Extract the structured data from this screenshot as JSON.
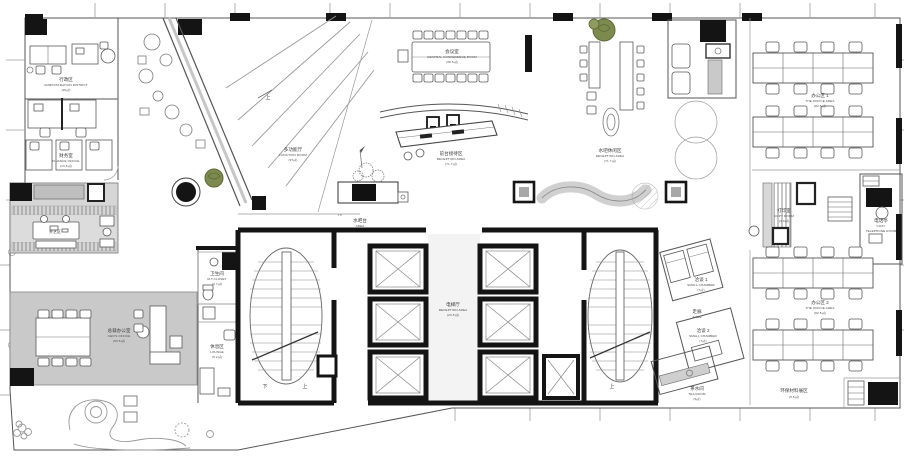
{
  "drawing": {
    "kind": "office floor plan",
    "colors": {
      "paper": "#ffffff",
      "wall_black": "#141414",
      "line_dark": "#555555",
      "line_light": "#9a9a9a",
      "room_gray": "#c9c9c9",
      "hatch_gray": "#bfbfbf",
      "plant_green": "#7d8a4f"
    }
  },
  "labels": {
    "admin": {
      "zh": "行政区",
      "en": "ADMINISTRATION DISTRICT",
      "area": "(26㎡)"
    },
    "finance": {
      "zh": "财务室",
      "en": "FINANCE OFFICE",
      "area": "(13.5㎡)"
    },
    "tea_art": {
      "zh": "茶艺区"
    },
    "ceo": {
      "zh": "总裁办公室",
      "en": "CEO'S OFFICE",
      "area": "(53.5㎡)"
    },
    "function": {
      "zh": "多功能厅",
      "en": "FUNCTION ROOM",
      "area": "(97㎡)"
    },
    "conference": {
      "zh": "会议室",
      "en": "CENTRAL CONFERENCE ROOM",
      "area": "(38.5㎡)"
    },
    "reception": {
      "zh": "前台接待区",
      "en": "RECEPTION AREA",
      "area": "(71.7㎡)"
    },
    "water_lounge": {
      "zh": "水吧休闲区",
      "en": "RECEPTION AREA",
      "area": "(71.7㎡)"
    },
    "tv": {
      "en": "TV"
    },
    "water_bar": {
      "zh": "水吧台",
      "en": "AREA",
      "area": "(91.7㎡)"
    },
    "elevator_hall": {
      "zh": "电梯厅",
      "en": "RECEPTION AREA",
      "area": "(23.5㎡)"
    },
    "wc": {
      "zh": "卫生间",
      "en": "M.T.CLOSET",
      "area": "(3.7㎡)"
    },
    "lounge": {
      "zh": "休息区",
      "en": "LOUNGE",
      "area": "(5.2㎡)"
    },
    "office1": {
      "zh": "办公区 1",
      "en": "THE OFFICE AREA",
      "area": "(82.5㎡)"
    },
    "office2": {
      "zh": "办公区 2",
      "en": "THE OFFICE AREA",
      "area": "(82.5㎡)"
    },
    "copy": {
      "zh": "打印室",
      "en": "COPY ROOM",
      "area": "(3.0㎡)"
    },
    "phone": {
      "zh": "电话亭",
      "en": "COZY",
      "en2": "TELEPHONE ROOM"
    },
    "chamber1": {
      "zh": "洽谈 1",
      "en": "SMALL CHAMBER",
      "area": "(7㎡)"
    },
    "aisle": {
      "zh": "走廊",
      "en": "AISLE"
    },
    "chamber2": {
      "zh": "洽谈 2",
      "en": "SMALL CHAMBER",
      "area": "(7㎡)"
    },
    "tea_room": {
      "zh": "茶水间",
      "en": "TEA ROOM",
      "area": "(5㎡)"
    },
    "eco": {
      "zh": "环保材料展区",
      "area": "(5.5㎡)"
    },
    "stair_up": {
      "zh": "上"
    },
    "stair_down": {
      "zh": "下"
    }
  }
}
